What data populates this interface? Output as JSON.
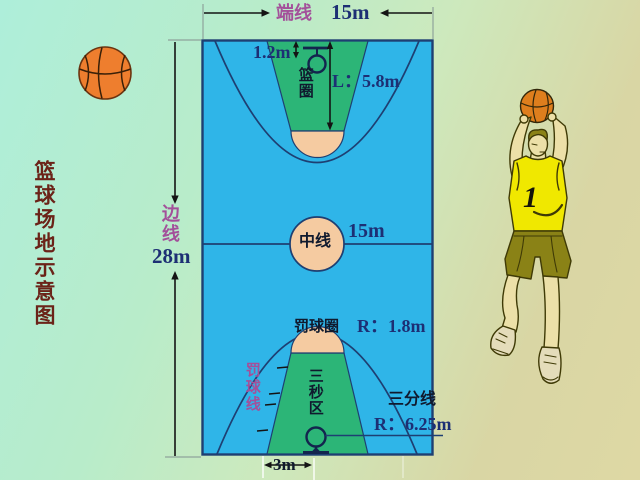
{
  "title": {
    "text": "篮球场地示意图"
  },
  "court": {
    "end_line_label": "端线",
    "end_line_value": "15m",
    "side_line_label": "边线",
    "side_line_value": "28m",
    "backboard_offset_value": "1.2m",
    "rim_label": "篮圈",
    "key_length_value": "L：5.8m",
    "center_line_label": "中线",
    "center_line_value": "15m",
    "free_throw_circle_label": "罚球圈",
    "free_throw_circle_value": "R：1.8m",
    "free_throw_line_label": "罚球线",
    "three_second_area_label": "三秒区",
    "three_point_line_label": "三分线",
    "three_point_line_value": "R：6.25m",
    "lane_base_value": "3m"
  },
  "player": {
    "jersey_number": "1"
  },
  "colors": {
    "court_blue": "#2fb5e8",
    "key_green": "#2cb577",
    "circle_peach": "#f5cba1",
    "line_navy": "#1e3f72",
    "label_purple": "#a3509a",
    "value_navy": "#1d2f74",
    "title_maroon": "#6b2318",
    "ball_orange": "#ee7e2e",
    "jersey_yellow": "#f0e800",
    "shorts_olive": "#8a8216"
  }
}
